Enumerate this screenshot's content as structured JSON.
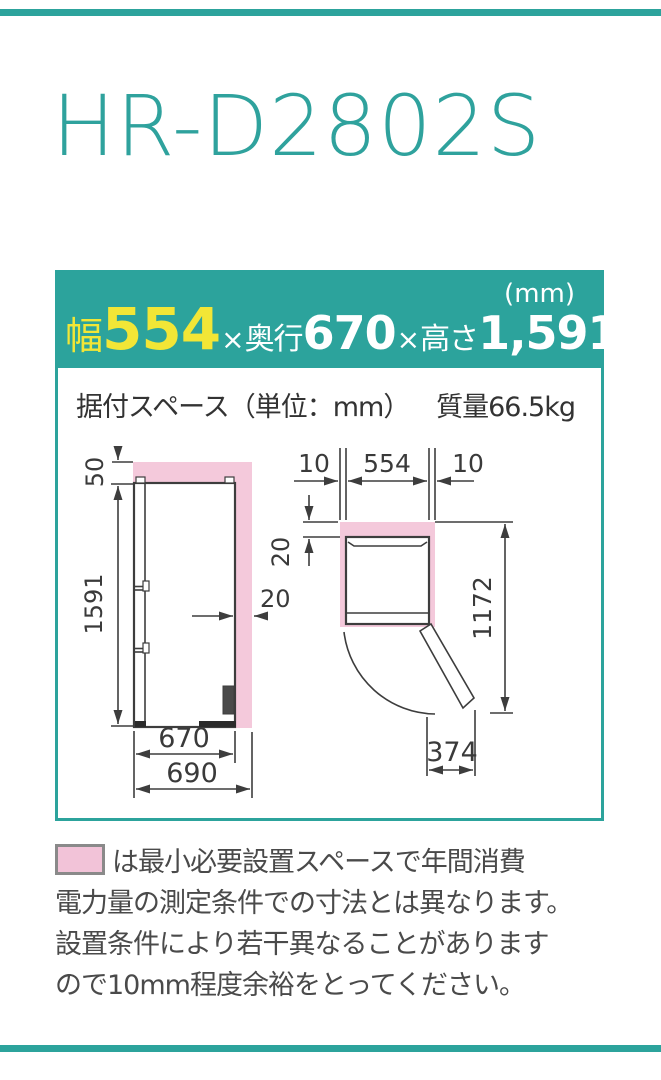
{
  "colors": {
    "accent_teal": "#2CA39C",
    "highlight_yellow": "#F2E636",
    "clearance_pink": "#F4C9DB",
    "legend_pink": "#F2C3D8",
    "drawing_line": "#3d3d3d"
  },
  "title": "HR-D2802S",
  "spec_header": {
    "unit": "(mm)",
    "width_label": "幅",
    "width_value": "554",
    "times1": "×",
    "depth_label": "奥行",
    "depth_value": "670",
    "times2": "×",
    "height_label": "高さ",
    "height_value": "1,591"
  },
  "install_row": {
    "label": "据付スペース（単位：mm）",
    "weight": "質量66.5kg"
  },
  "diagram": {
    "side_view": {
      "top_clearance": "50",
      "height": "1591",
      "rear_clearance": "20",
      "depth": "670",
      "total_depth": "690"
    },
    "top_view": {
      "left_clearance": "10",
      "width": "554",
      "right_clearance": "10",
      "rear_clearance": "20",
      "front_space": "1172",
      "door_swing": "374"
    }
  },
  "footnote": {
    "lines": [
      "は最小必要設置スペースで年間消費",
      "電力量の測定条件での寸法とは異なります。",
      "設置条件により若干異なることがあります",
      "ので10mm程度余裕をとってください。"
    ]
  }
}
